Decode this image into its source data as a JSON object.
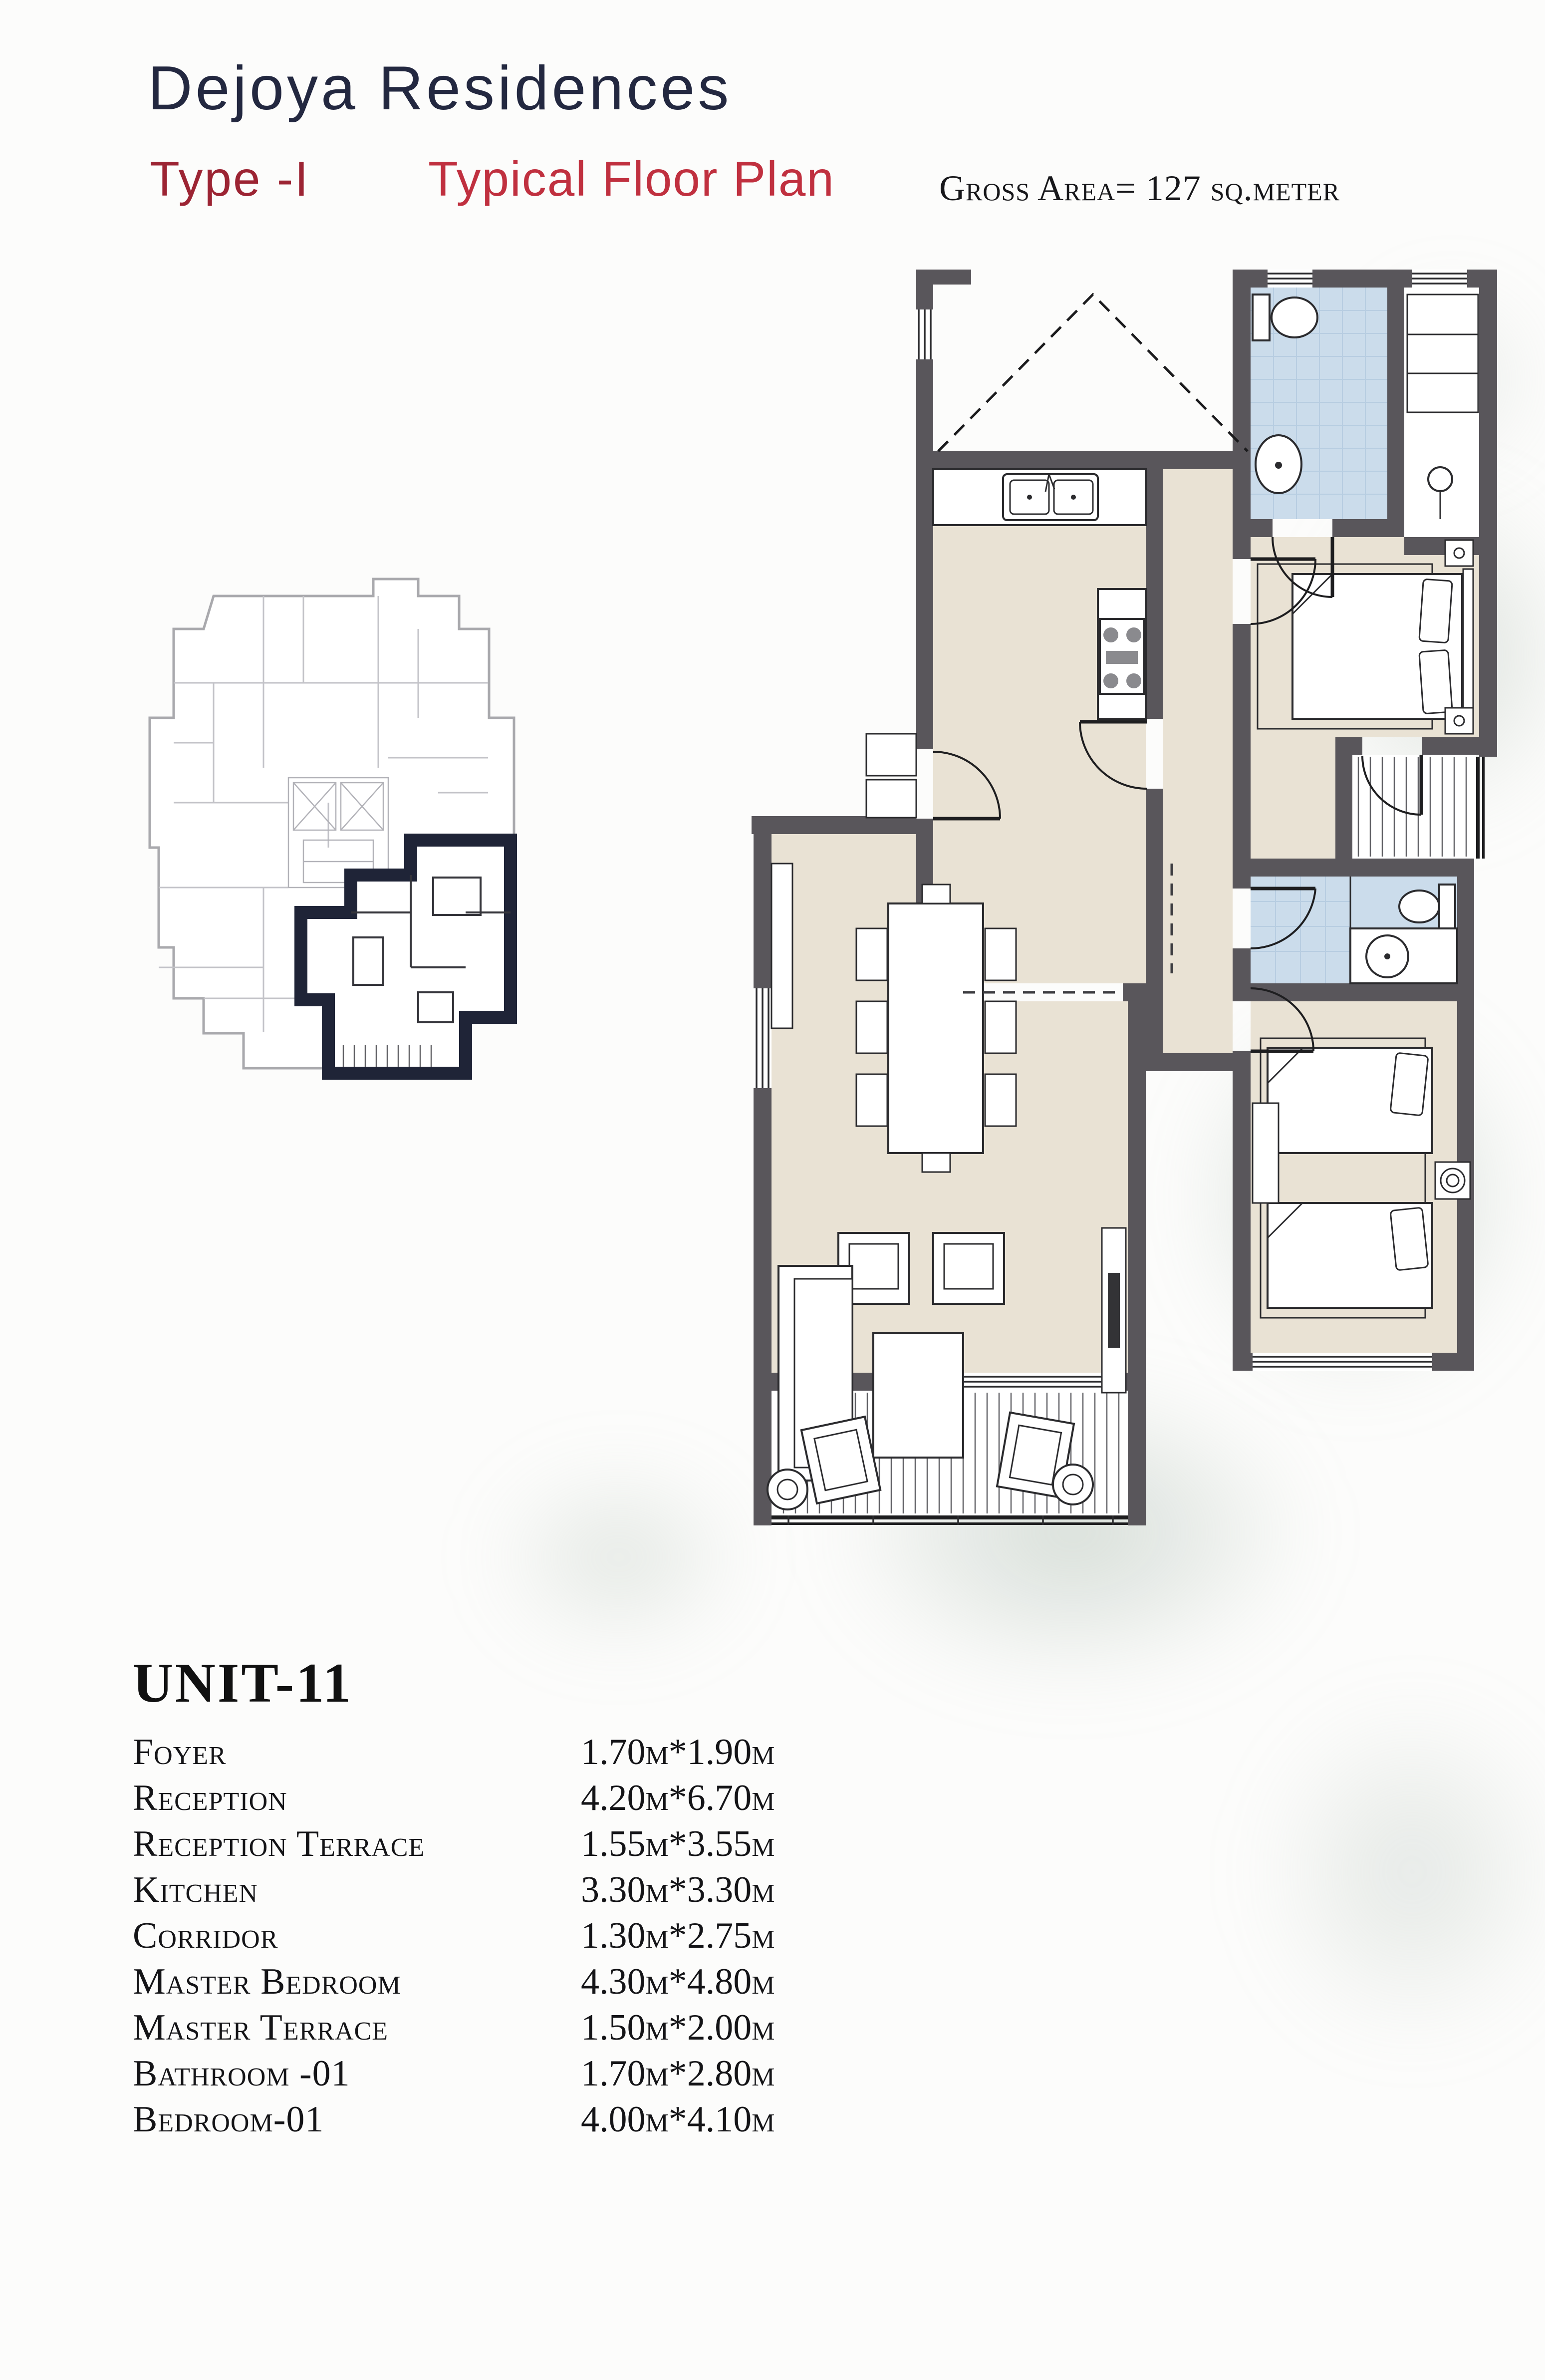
{
  "header": {
    "title": "Dejoya Residences",
    "type_label": "Type -I",
    "plan_label": "Typical Floor Plan",
    "gross_area": "Gross Area= 127 sq.meter"
  },
  "unit": {
    "title": "UNIT-11"
  },
  "rooms": [
    {
      "name": "Foyer",
      "dim": "1.70m*1.90m"
    },
    {
      "name": "Reception",
      "dim": "4.20m*6.70m"
    },
    {
      "name": "Reception Terrace",
      "dim": "1.55m*3.55m"
    },
    {
      "name": "Kitchen",
      "dim": "3.30m*3.30m"
    },
    {
      "name": "Corridor",
      "dim": "1.30m*2.75m"
    },
    {
      "name": "Master Bedroom",
      "dim": "4.30m*4.80m"
    },
    {
      "name": "Master Terrace",
      "dim": "1.50m*2.00m"
    },
    {
      "name": "Bathroom -01",
      "dim": "1.70m*2.80m"
    },
    {
      "name": "Bedroom-01",
      "dim": "4.00m*4.10m"
    }
  ],
  "colors": {
    "wall": "#59565b",
    "floor": "#e9e2d4",
    "bath": "#cbdceb",
    "title_navy": "#232840",
    "dark_red": "#9c2433",
    "red": "#c0303f",
    "highlight": "#1f2437"
  }
}
